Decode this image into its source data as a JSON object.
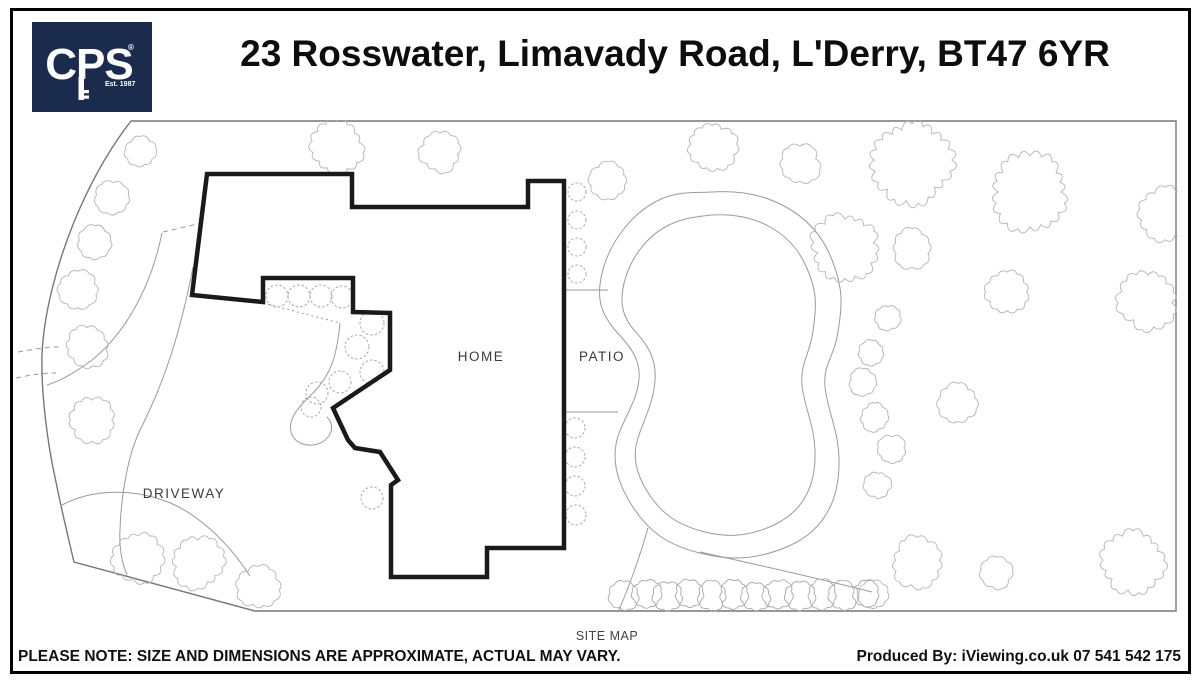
{
  "colors": {
    "navy": "#1b2b4d",
    "house_line": "#1a1a1a",
    "boundary_line": "#777777",
    "detail_line": "#9a9a9a",
    "tree_line": "#b4b4b4",
    "shrub_line": "#a9a9a9",
    "label_text": "#3a3a3a",
    "title_text": "#0d0d0d"
  },
  "header": {
    "title": "23 Rosswater, Limavady Road, L'Derry, BT47 6YR",
    "logo": {
      "monogram": "CPS",
      "established": "Est. 1987",
      "registered": "®"
    }
  },
  "map": {
    "labels": {
      "home": "HOME",
      "patio": "PATIO",
      "driveway": "DRIVEWAY",
      "caption": "SITE MAP"
    },
    "trees": [
      [
        140,
        152,
        15
      ],
      [
        113,
        198,
        17
      ],
      [
        95,
        243,
        17
      ],
      [
        78,
        289,
        18
      ],
      [
        87,
        347,
        20
      ],
      [
        92,
        420,
        21
      ],
      [
        337,
        147,
        25
      ],
      [
        440,
        152,
        20
      ],
      [
        608,
        180,
        18
      ],
      [
        712,
        147,
        23
      ],
      [
        800,
        164,
        19
      ],
      [
        912,
        163,
        38
      ],
      [
        1030,
        192,
        36
      ],
      [
        1165,
        215,
        26
      ],
      [
        845,
        248,
        32
      ],
      [
        912,
        248,
        19
      ],
      [
        1148,
        300,
        28
      ],
      [
        1007,
        292,
        21
      ],
      [
        958,
        403,
        19
      ],
      [
        888,
        318,
        12
      ],
      [
        872,
        353,
        12
      ],
      [
        863,
        382,
        13
      ],
      [
        875,
        417,
        14
      ],
      [
        892,
        450,
        14
      ],
      [
        878,
        485,
        13
      ],
      [
        917,
        563,
        24
      ],
      [
        997,
        573,
        15
      ],
      [
        1133,
        563,
        30
      ],
      [
        873,
        595,
        14
      ],
      [
        138,
        558,
        24
      ],
      [
        198,
        562,
        25
      ],
      [
        258,
        587,
        20
      ]
    ],
    "shrubs": [
      [
        577,
        192,
        9
      ],
      [
        577,
        220,
        9
      ],
      [
        577,
        247,
        9
      ],
      [
        577,
        274,
        9
      ],
      [
        575,
        428,
        10
      ],
      [
        575,
        457,
        10
      ],
      [
        575,
        486,
        10
      ],
      [
        576,
        515,
        10
      ],
      [
        277,
        296,
        11
      ],
      [
        299,
        296,
        11
      ],
      [
        321,
        296,
        11
      ],
      [
        342,
        297,
        11
      ],
      [
        372,
        323,
        12
      ],
      [
        357,
        347,
        12
      ],
      [
        372,
        372,
        12
      ],
      [
        340,
        382,
        11
      ],
      [
        317,
        393,
        11
      ],
      [
        311,
        407,
        10
      ],
      [
        372,
        498,
        11
      ]
    ],
    "bushes": [
      [
        624,
        596,
        14
      ],
      [
        646,
        594,
        14
      ],
      [
        668,
        596,
        14
      ],
      [
        690,
        594,
        14
      ],
      [
        712,
        596,
        14
      ],
      [
        734,
        594,
        14
      ],
      [
        756,
        596,
        14
      ],
      [
        778,
        594,
        14
      ],
      [
        800,
        596,
        14
      ],
      [
        822,
        594,
        14
      ],
      [
        844,
        596,
        14
      ],
      [
        866,
        594,
        13
      ]
    ]
  },
  "footer": {
    "note": "PLEASE NOTE: SIZE AND DIMENSIONS ARE APPROXIMATE, ACTUAL MAY VARY.",
    "produced_by": "Produced By: iViewing.co.uk 07 541 542 175"
  }
}
